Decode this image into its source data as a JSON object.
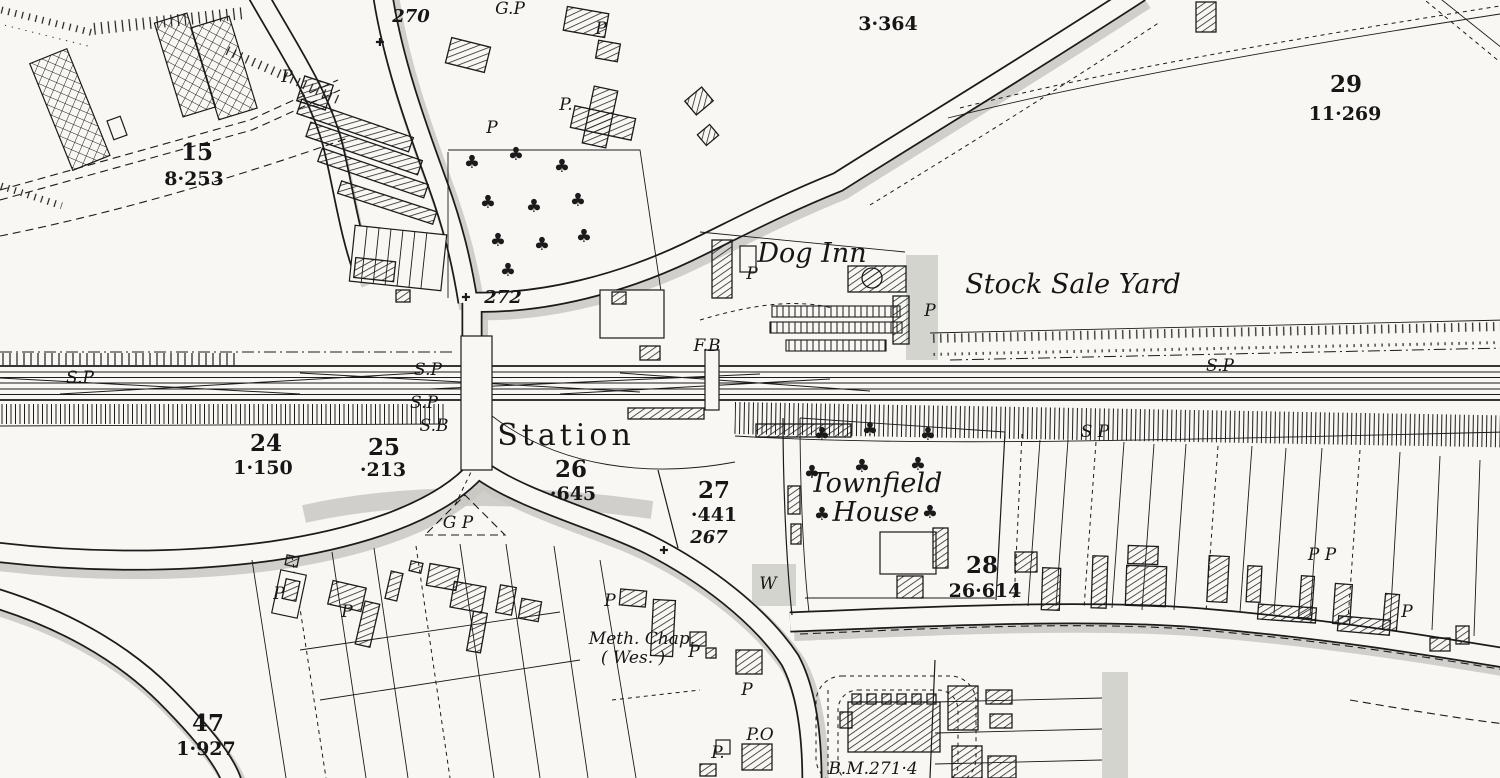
{
  "map": {
    "type": "historical-town-plan",
    "colors": {
      "ink": "#1b1b1b",
      "paper": "#f8f7f3",
      "road_shade": "#c9c8c3"
    },
    "icons": {
      "tree": "♣",
      "boundary_cross": "✚"
    },
    "labels": [
      {
        "text": "270",
        "x": 411,
        "y": 22,
        "style": "spot"
      },
      {
        "text": "G.P",
        "x": 510,
        "y": 14,
        "style": "abbr"
      },
      {
        "text": "P",
        "x": 287,
        "y": 82,
        "style": "abbr"
      },
      {
        "text": "P",
        "x": 601,
        "y": 34,
        "style": "abbr"
      },
      {
        "text": "3·364",
        "x": 888,
        "y": 30,
        "style": "area"
      },
      {
        "text": "29",
        "x": 1346,
        "y": 92,
        "style": "num"
      },
      {
        "text": "11·269",
        "x": 1345,
        "y": 120,
        "style": "area"
      },
      {
        "text": "15",
        "x": 197,
        "y": 160,
        "style": "num"
      },
      {
        "text": "8·253",
        "x": 194,
        "y": 185,
        "style": "area"
      },
      {
        "text": "P.",
        "x": 566,
        "y": 110,
        "style": "abbr"
      },
      {
        "text": "P",
        "x": 492,
        "y": 133,
        "style": "abbr"
      },
      {
        "text": "Dog Inn",
        "x": 812,
        "y": 262,
        "style": "name"
      },
      {
        "text": "P",
        "x": 752,
        "y": 279,
        "style": "abbr"
      },
      {
        "text": "Stock Sale Yard",
        "x": 1073,
        "y": 293,
        "style": "name"
      },
      {
        "text": "P",
        "x": 930,
        "y": 316,
        "style": "abbr"
      },
      {
        "text": "272",
        "x": 503,
        "y": 303,
        "style": "spot"
      },
      {
        "text": "F.B",
        "x": 707,
        "y": 351,
        "style": "abbr"
      },
      {
        "text": "S.P",
        "x": 80,
        "y": 383,
        "style": "abbr"
      },
      {
        "text": "S.P",
        "x": 428,
        "y": 375,
        "style": "abbr"
      },
      {
        "text": "S.P",
        "x": 424,
        "y": 408,
        "style": "abbr"
      },
      {
        "text": "S.P",
        "x": 1220,
        "y": 371,
        "style": "abbr"
      },
      {
        "text": "S.B",
        "x": 434,
        "y": 431,
        "style": "abbr"
      },
      {
        "text": "Station",
        "x": 566,
        "y": 445,
        "style": "big"
      },
      {
        "text": "24",
        "x": 266,
        "y": 451,
        "style": "num"
      },
      {
        "text": "1·150",
        "x": 263,
        "y": 474,
        "style": "area"
      },
      {
        "text": "25",
        "x": 384,
        "y": 455,
        "style": "num"
      },
      {
        "text": "·213",
        "x": 383,
        "y": 476,
        "style": "area"
      },
      {
        "text": "26",
        "x": 571,
        "y": 477,
        "style": "num"
      },
      {
        "text": "·645",
        "x": 573,
        "y": 500,
        "style": "area"
      },
      {
        "text": "27",
        "x": 714,
        "y": 498,
        "style": "num"
      },
      {
        "text": "·441",
        "x": 714,
        "y": 521,
        "style": "area"
      },
      {
        "text": "267",
        "x": 709,
        "y": 543,
        "style": "spot"
      },
      {
        "text": "G P",
        "x": 458,
        "y": 528,
        "style": "abbr"
      },
      {
        "text": "Townfield",
        "x": 876,
        "y": 492,
        "style": "name"
      },
      {
        "text": "House",
        "x": 876,
        "y": 521,
        "style": "name"
      },
      {
        "text": "S P",
        "x": 1095,
        "y": 437,
        "style": "abbr"
      },
      {
        "text": "28",
        "x": 982,
        "y": 573,
        "style": "num"
      },
      {
        "text": "26·614",
        "x": 985,
        "y": 597,
        "style": "area"
      },
      {
        "text": "W",
        "x": 768,
        "y": 589,
        "style": "abbr"
      },
      {
        "text": "P",
        "x": 279,
        "y": 599,
        "style": "abbr"
      },
      {
        "text": "P",
        "x": 347,
        "y": 617,
        "style": "abbr"
      },
      {
        "text": "P",
        "x": 610,
        "y": 606,
        "style": "abbr"
      },
      {
        "text": "Meth. Chap.",
        "x": 642,
        "y": 644,
        "style": "abbr"
      },
      {
        "text": "( Wes. )",
        "x": 633,
        "y": 663,
        "style": "abbr"
      },
      {
        "text": "P",
        "x": 694,
        "y": 657,
        "style": "abbr"
      },
      {
        "text": "P",
        "x": 747,
        "y": 695,
        "style": "abbr"
      },
      {
        "text": "P.O",
        "x": 760,
        "y": 740,
        "style": "abbr"
      },
      {
        "text": "P.",
        "x": 718,
        "y": 758,
        "style": "abbr"
      },
      {
        "text": "P P",
        "x": 1322,
        "y": 560,
        "style": "abbr"
      },
      {
        "text": "P",
        "x": 1407,
        "y": 617,
        "style": "abbr"
      },
      {
        "text": "47",
        "x": 208,
        "y": 731,
        "style": "num"
      },
      {
        "text": "1·927",
        "x": 206,
        "y": 755,
        "style": "area"
      },
      {
        "text": "B.M.271·4",
        "x": 873,
        "y": 774,
        "style": "abbr"
      }
    ]
  }
}
